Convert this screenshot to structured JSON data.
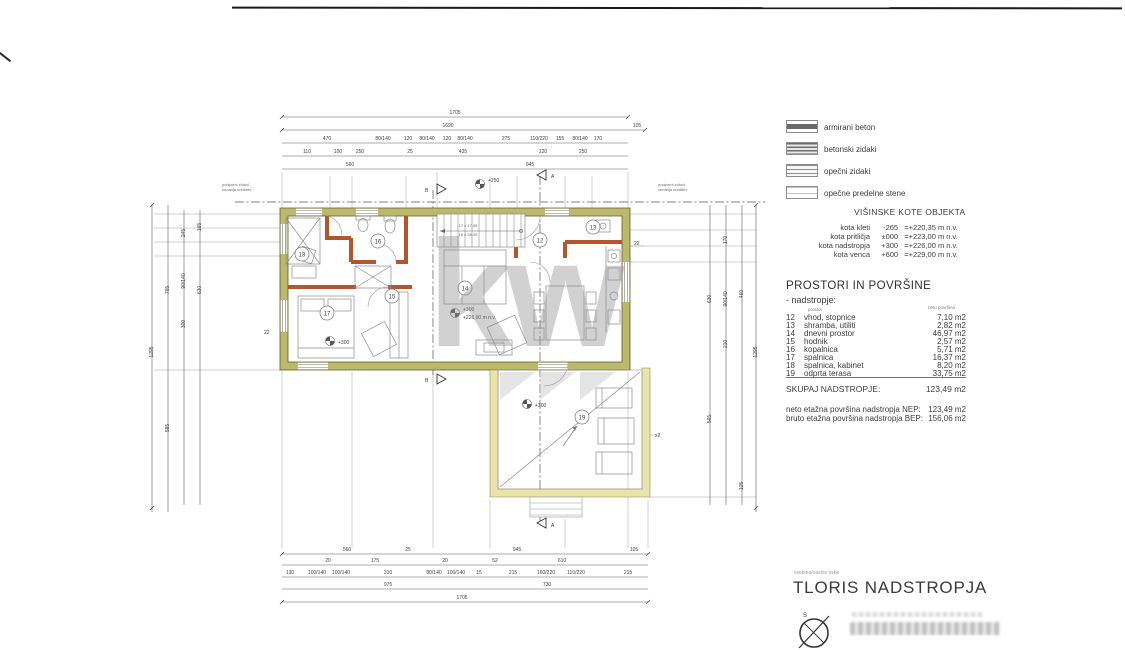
{
  "legend": {
    "items": [
      {
        "label": "armirani beton"
      },
      {
        "label": "betonski zidaki"
      },
      {
        "label": "opečni zidaki"
      },
      {
        "label": "opečne predelne stene"
      }
    ]
  },
  "kote": {
    "title": "VIŠINSKE KOTE OBJEKTA",
    "rows": [
      {
        "name": "kota kleti",
        "rel": "-265",
        "abs": "=+220,35 m n.v."
      },
      {
        "name": "kota pritličja",
        "rel": "±000",
        "abs": "=+223,00 m n.v."
      },
      {
        "name": "kota nadstropja",
        "rel": "+300",
        "abs": "=+226,00 m n.v."
      },
      {
        "name": "kota venca",
        "rel": "+600",
        "abs": "=+229,00 m n.v."
      }
    ]
  },
  "prostori": {
    "title": "PROSTORI IN POVRŠINE",
    "subtitle": "- nadstropje:",
    "col_prostor": "prostor",
    "col_povrsina": "neto površina",
    "rows": [
      {
        "num": "12",
        "name": "vhod, stopnice",
        "area": "7,10 m2"
      },
      {
        "num": "13",
        "name": "shramba, utiliti",
        "area": "2,82 m2"
      },
      {
        "num": "14",
        "name": "dnevni prostor",
        "area": "46,97 m2"
      },
      {
        "num": "15",
        "name": "hodnik",
        "area": "2,57 m2"
      },
      {
        "num": "16",
        "name": "kopalnica",
        "area": "5,71 m2"
      },
      {
        "num": "17",
        "name": "spalnica",
        "area": "16,37 m2"
      },
      {
        "num": "18",
        "name": "spalnica, kabinet",
        "area": "8,20 m2"
      },
      {
        "num": "19",
        "name": "odprta terasa",
        "area": "33,75 m2"
      }
    ],
    "skupaj_label": "SKUPAJ NADSTROPJE:",
    "skupaj_value": "123,49 m2",
    "nep_label": "neto etažna površina nadstropja NEP:",
    "nep_value": "123,49 m2",
    "bep_label": "bruto etažna površina nadstropja BEP:",
    "bep_value": "156,06 m2"
  },
  "titleblock": {
    "caption": "vsebina/naslov risbe",
    "title": "TLORIS NADSTROPJA",
    "compass_n": "S"
  },
  "watermark": "kw",
  "plan": {
    "rooms": {
      "r12": "12",
      "r13": "13",
      "r14": "14",
      "r15": "15",
      "r16": "16",
      "r17": "17",
      "r18": "18",
      "r19": "19"
    },
    "levels": {
      "l250": "+250",
      "l300": "+300",
      "l300abs": "+226,00 m n.v."
    },
    "stairs1": "17 x 17,65",
    "stairs2": "16 x 28,00",
    "secA": "A",
    "secB": "B",
    "note1": "podporni zidovi",
    "note2": "zunanja ureditev",
    "m22": "22",
    "x2": "x2",
    "dims": {
      "t1": [
        "1705"
      ],
      "t2": [
        "1690",
        "105"
      ],
      "t3": [
        "470",
        "80/140",
        "120",
        "80/140",
        "120",
        "80/140",
        "275",
        "110/220",
        "155",
        "80/140",
        "170"
      ],
      "t4": [
        "110",
        "100",
        "250",
        "25",
        "435",
        "220",
        "250"
      ],
      "t5": [
        "560",
        "945"
      ],
      "b1": [
        "560",
        "25",
        "945",
        "105"
      ],
      "b2": [
        "20",
        "175",
        "20",
        "52",
        "610"
      ],
      "b3": [
        "130",
        "100/140",
        "100/140",
        "310",
        "80/140",
        "100/140",
        "15",
        "215",
        "160/220",
        "110/220",
        "215"
      ],
      "b4": [
        "975",
        "730"
      ],
      "b5": [
        "1705"
      ],
      "l": [
        "1295",
        "765",
        "585",
        "245",
        "90/140",
        "300",
        "165",
        "630"
      ],
      "r": [
        "630",
        "565",
        "170",
        "90/140",
        "210",
        "460",
        "105",
        "1295"
      ]
    }
  }
}
